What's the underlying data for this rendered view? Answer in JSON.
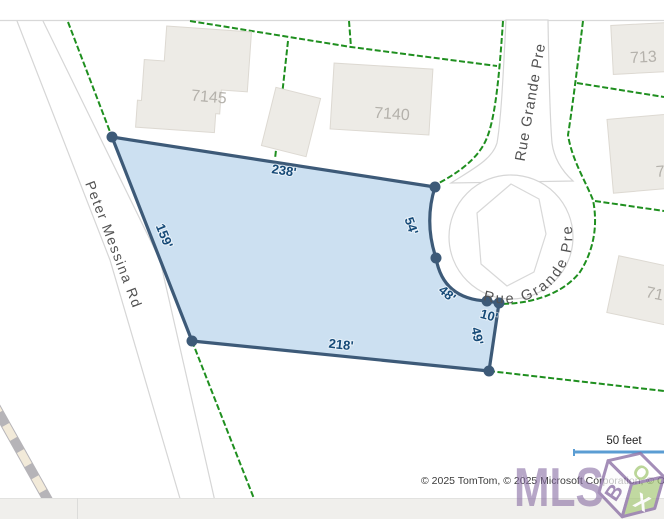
{
  "map": {
    "road_labels": {
      "peter_messina": "Peter Messina Rd",
      "rue_grande_pre_straight": "Rue Grande Pre",
      "rue_grande_pre_curved": "Rue Grande Pre"
    },
    "parcel_dimensions": {
      "top": "238'",
      "left": "159'",
      "bottom": "218'",
      "side_54": "54'",
      "side_48": "48'",
      "side_10": "10'",
      "side_49": "49'"
    },
    "building_numbers": {
      "b7145": "7145",
      "b7140": "7140",
      "b_top_right": "713",
      "b_right_mid": "7",
      "b_right_low": "71"
    },
    "scale_label": "50 feet",
    "attribution": "© 2025 TomTom, © 2025 Microsoft Corporation, © O",
    "logo": {
      "text": "MLS",
      "cube_top": "O",
      "cube_left": "B",
      "cube_right": "X"
    },
    "colors": {
      "parcel_fill": "#b9d4ec",
      "parcel_border": "#3d5a78",
      "parcel_boundary_green": "#1f8f1f",
      "dimension_text": "#164a77",
      "scale_bar_blue": "#5b9dd3",
      "logo_purple": "#8b6fa5",
      "logo_green": "#a9cb7d",
      "building_fill": "#edebe6"
    }
  }
}
